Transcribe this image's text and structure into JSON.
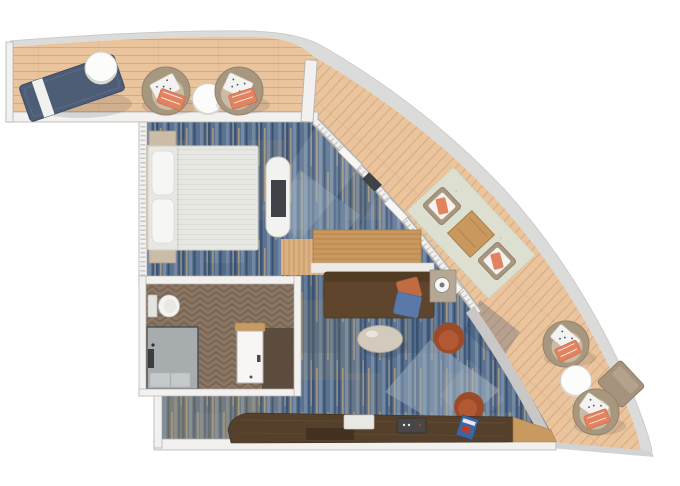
{
  "figure": {
    "kind": "cruise-ship-suite-floorplan",
    "view": "top-down",
    "width_px": 680,
    "height_px": 486
  },
  "rooms": [
    {
      "name": "wraparound-balcony"
    },
    {
      "name": "bedroom"
    },
    {
      "name": "bathroom"
    },
    {
      "name": "living-room"
    }
  ],
  "furniture": [
    "sun-lounger",
    "balcony-side-table",
    "patio-armchair-left",
    "patio-round-table",
    "patio-armchair-right",
    "double-bed",
    "nightstand-upper",
    "nightstand-lower",
    "tv-console",
    "tv",
    "toilet",
    "shower-enclosure",
    "bathroom-door",
    "desk",
    "sofa",
    "sofa-pillow-orange",
    "sofa-pillow-blue",
    "lamp-side-table",
    "coffee-table",
    "rust-armchair-mid",
    "rust-desk-chair",
    "wet-bar-counter",
    "tray",
    "coffee-machine",
    "magazine",
    "dining-rug",
    "dining-table",
    "dining-chair-upper",
    "dining-chair-lower",
    "lounge-chair-right-upper",
    "balcony-round-table-right",
    "lounge-chair-right-lower",
    "chaise-ottoman"
  ],
  "palette": {
    "background": "#ffffff",
    "hull_band": "#dbdbda",
    "deck_wood": "#eac49d",
    "deck_plank_line": "#d2a377",
    "wall_fill": "#f2f1ef",
    "wall_edge": "#b5b3b0",
    "glass_tick": "#a9a8a4",
    "solid_wall_gray": "#c9c8c6",
    "carpet_base": "#5b7290",
    "carpet_streak_dark": "#33496b",
    "carpet_streak_navy": "#2f4767",
    "carpet_streak_gold": "#c2a878",
    "carpet_streak_light": "#8fa3b8",
    "carpet_patch_light": "#9db0bf",
    "bathroom_floor": "#8b7765",
    "bathroom_floor_line": "#75604d",
    "bathroom_nook_dark": "#57483a",
    "shower_gray": "#a7acaf",
    "shower_mat": "#c6c9cb",
    "bed_linen": "#e7e7e4",
    "pillow_white": "#f6f6f4",
    "headboard": "#cfc6b4",
    "nightstand_wood": "#cabca6",
    "tv_dark": "#3f4347",
    "console_white": "#f2f2ef",
    "entry_wood": "#dcb182",
    "desk_wood": "#c9985f",
    "ledge_white": "#eceae6",
    "sofa_brown": "#5e452c",
    "sofa_back": "#523c24",
    "pillow_orange": "#c06b42",
    "pillow_blue": "#5b79a8",
    "side_table_taupe": "#b7a896",
    "coffee_table_greige": "#d3cabb",
    "chair_rust_dark": "#9c4b29",
    "chair_rust": "#b25934",
    "counter_walnut": "#55402b",
    "counter_inset": "#42321f",
    "counter_oak": "#c99a5f",
    "lounger_navy": "#4e5d76",
    "towel_white": "#f1f1ef",
    "patio_chair_taupe": "#a8977f",
    "patio_seat_tan": "#cbbba4",
    "cushion_coral": "#e2825f",
    "cushion_dotted_white": "#f4f3f0",
    "dot_navy": "#3d5577",
    "dining_rug_sage": "#dde0d0",
    "round_table_white": "#fcfcfb",
    "ottoman_taupe": "#a5937d",
    "magazine_blue": "#3f64a0",
    "magazine_red": "#c0392b",
    "appliance_dark": "#474747",
    "tray_white": "#e8e8e5"
  }
}
